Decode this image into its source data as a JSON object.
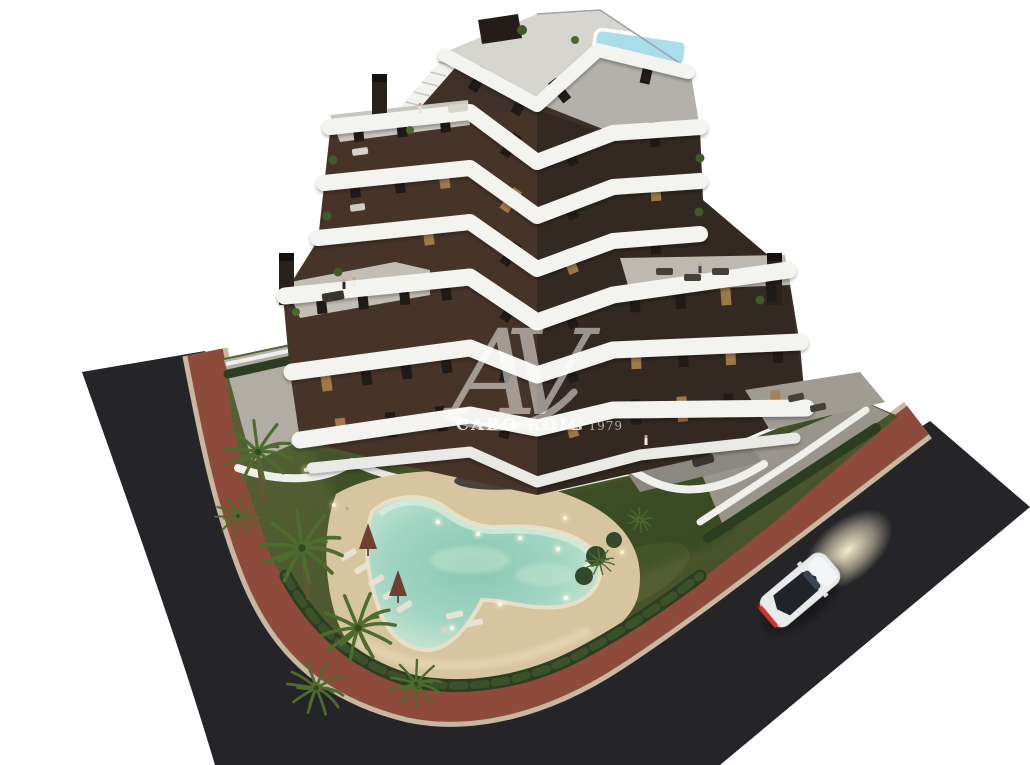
{
  "meta": {
    "type": "architectural-3d-render",
    "description": "Aerial dusk render of a modern apartment building with dark brown facade, white curved balcony bands, rooftop plunge pool, landscaped garden with lit free-form swimming pool, palm trees, wrap-around asphalt streets with terracotta sidewalks and a white car",
    "width": 1030,
    "height": 765
  },
  "watermark": {
    "monogram": "AV",
    "brand": "CABO ROIG",
    "tagline": "Desde 1979"
  },
  "palette": {
    "background": "#ffffff",
    "asphalt": "#323136",
    "sidewalk": "#8e4b3c",
    "curb": "#c8b8a1",
    "lawn": "#5a6836",
    "lawn_shade": "#4c5a2e",
    "deck_sand": "#d7c5a0",
    "pool_water": "#8fcbb9",
    "pool_edge": "#e9dfc8",
    "facade": "#3f3129",
    "band_white": "#f3f3f0",
    "roof_deck": "#d6d5d0",
    "terrace_gray": "#b9b5ad",
    "wall_white": "#efefec",
    "rooftop_pool": "#a9dde9",
    "window": "#201b18",
    "window_lit": "#a97f4c",
    "hedge": "#2c3e22",
    "palm": "#4d6c2e",
    "palm_light": "#95a947",
    "trunk": "#6b5138",
    "car_body": "#e9eaec",
    "car_glass": "#20242a",
    "taillight": "#d3302a",
    "headlight_glow": "#fff3cf"
  },
  "scene": {
    "building": {
      "visible_floors": 7,
      "facade_style": "dark brown with vertical windows, several lit",
      "balcony_style": "white rounded zig-zag bands",
      "rooftop_features": [
        "roof terrace",
        "plunge pool",
        "external white staircase",
        "chimneys",
        "pergola"
      ]
    },
    "garden": {
      "pool": "free-form heart-shaped pool with underwater lights",
      "features": [
        "sun loungers",
        "closed parasols",
        "palm trees",
        "hedges",
        "lawn",
        "oval planting island"
      ]
    },
    "streets": {
      "surface": "dark asphalt",
      "sidewalk": "terracotta pavement with light curbs"
    },
    "car": {
      "color": "white",
      "state": "driving with headlights on and red taillights lit"
    }
  }
}
